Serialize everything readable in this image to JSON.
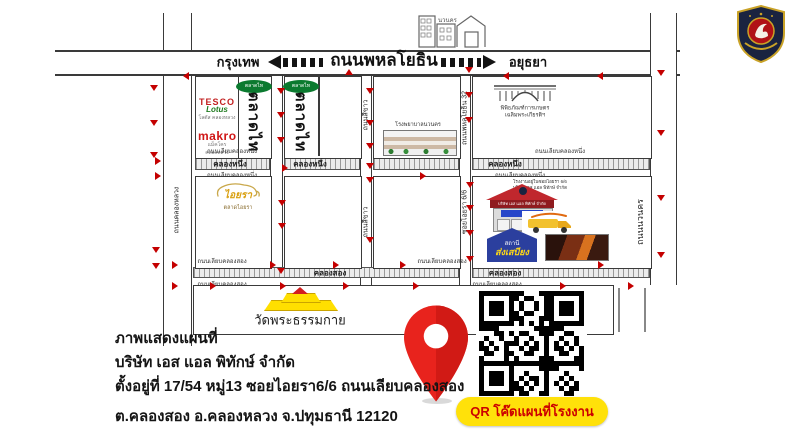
{
  "highway": {
    "title": "ถนนพหลโยธิน",
    "left_city": "กรุงเทพ",
    "right_city": "อยุธยา"
  },
  "roads": {
    "khlong_luang": "ถนนคลองหลวง",
    "si_khao": "ถนนสีขาว",
    "soi32": "ถนนพหลโยธิน 32",
    "soi_aiyara": "ซอยไอยรา 6/6",
    "right_road": "ถนนนวนคร"
  },
  "landmarks": {
    "nava_nakorn": "นวนคร",
    "tesco_line1": "TESCO",
    "tesco_line2": "Lotus",
    "tesco_sub": "โลตัส คลองหลวง",
    "makro": "makro",
    "makro_sub": "แม็คโคร คลองหลวง",
    "talad_thai": "ตลาดไท",
    "talad_thai_logo": "ตลาดไท",
    "hospital": "โรงพยาบาลนวนคร",
    "museum_line1": "พิพิธภัณฑ์การเกษตร",
    "museum_line2": "เฉลิมพระเกียรติฯ",
    "aiyara": "ไอยรา",
    "aiyara_sub": "ตลาดไอยรา",
    "factory_note_line1": "โรงงานอยู่ในซอยไอยรา 6/6",
    "factory_note_line2": "บริษัท เอส แอล พิทักษ์ จำกัด",
    "factory_sign": "บริษัท เอส แอล พิทักษ์ จำกัด",
    "station_line1": "สถานี",
    "station_line2": "ส่งเสบียง",
    "temple": "วัดพระธรรมกาย"
  },
  "address": {
    "line1": "ภาพแสดงแผนที่",
    "line2": "บริษัท เอส แอล พิทักษ์ จำกัด",
    "line3": "ตั้งอยู่ที่ 17/54 หมู่13 ซอยไอยรา6/6 ถนนเลียบคลองสอง",
    "line4": "ต.คลองสอง อ.คลองหลวง จ.ปทุมธานี 12120"
  },
  "qr": {
    "label": "QR โค๊ดแผนที่โรงงาน"
  },
  "colors": {
    "arrow_red": "#c40000",
    "pin_red": "#e8231d",
    "pill_yellow": "#ffe10a",
    "pill_text_red": "#cc0000",
    "talad_green": "#0b7a2f",
    "makro_red": "#d01616",
    "factory_roof_red": "#c0272d",
    "station_blue": "#2b3f9e",
    "temple_yellow": "#ffdf00"
  },
  "map": {
    "labels": [
      [
        230,
        163.5,
        "คลองหนึ่ง",
        "canal-name"
      ],
      [
        310,
        163.5,
        "คลองหนึ่ง",
        "canal-name"
      ],
      [
        505,
        163.5,
        "คลองหนึ่ง",
        "canal-name"
      ],
      [
        330,
        272.5,
        "คลองสอง",
        "canal-name"
      ],
      [
        505,
        272.5,
        "คลองสอง",
        "canal-name"
      ],
      [
        232,
        151,
        "ถนนเลียบคลองหนึ่ง",
        "tiny-road"
      ],
      [
        560,
        151,
        "ถนนเลียบคลองหนึ่ง",
        "tiny-road"
      ],
      [
        232,
        175,
        "ถนนเลียบคลองหนึ่ง",
        "tiny-road"
      ],
      [
        520,
        175,
        "ถนนเลียบคลองหนึ่ง",
        "tiny-road"
      ],
      [
        222,
        261,
        "ถนนเลียบคลองสอง",
        "tiny-road"
      ],
      [
        442,
        261,
        "ถนนเลียบคลองสอง",
        "tiny-road"
      ],
      [
        222,
        283.5,
        "ถนนเลียบคลองสอง",
        "tiny-road"
      ],
      [
        497,
        283.5,
        "ถนนเลียบคลองสอง",
        "tiny-road"
      ]
    ],
    "arrows": [
      [
        150,
        85,
        "down"
      ],
      [
        150,
        120,
        "down"
      ],
      [
        150,
        152,
        "down"
      ],
      [
        152,
        247,
        "down"
      ],
      [
        152,
        263,
        "down"
      ],
      [
        277,
        88,
        "down"
      ],
      [
        277,
        112,
        "down"
      ],
      [
        277,
        137,
        "down"
      ],
      [
        278,
        200,
        "down"
      ],
      [
        278,
        223,
        "down"
      ],
      [
        277,
        268,
        "down"
      ],
      [
        366,
        88,
        "down"
      ],
      [
        366,
        120,
        "down"
      ],
      [
        366,
        143,
        "down"
      ],
      [
        366,
        163,
        "down"
      ],
      [
        366,
        177,
        "down"
      ],
      [
        366,
        237,
        "down"
      ],
      [
        465,
        67,
        "down"
      ],
      [
        465,
        92,
        "down"
      ],
      [
        465,
        117,
        "down"
      ],
      [
        466,
        182,
        "down"
      ],
      [
        466,
        205,
        "down"
      ],
      [
        466,
        230,
        "down"
      ],
      [
        466,
        256,
        "down"
      ],
      [
        657,
        70,
        "down"
      ],
      [
        657,
        130,
        "down"
      ],
      [
        657,
        195,
        "down"
      ],
      [
        657,
        252,
        "down"
      ],
      [
        183,
        72,
        "left"
      ],
      [
        345,
        69,
        "up"
      ],
      [
        503,
        72,
        "left"
      ],
      [
        597,
        72,
        "left"
      ],
      [
        155,
        157,
        "right"
      ],
      [
        155,
        172,
        "right"
      ],
      [
        282,
        164,
        "right"
      ],
      [
        420,
        172,
        "right"
      ],
      [
        172,
        261,
        "right"
      ],
      [
        270,
        261,
        "right"
      ],
      [
        333,
        261,
        "right"
      ],
      [
        400,
        261,
        "right"
      ],
      [
        598,
        261,
        "right"
      ],
      [
        172,
        282,
        "right"
      ],
      [
        210,
        282,
        "right"
      ],
      [
        280,
        282,
        "right"
      ],
      [
        343,
        282,
        "right"
      ],
      [
        413,
        282,
        "right"
      ],
      [
        560,
        282,
        "right"
      ],
      [
        628,
        282,
        "right"
      ]
    ]
  }
}
